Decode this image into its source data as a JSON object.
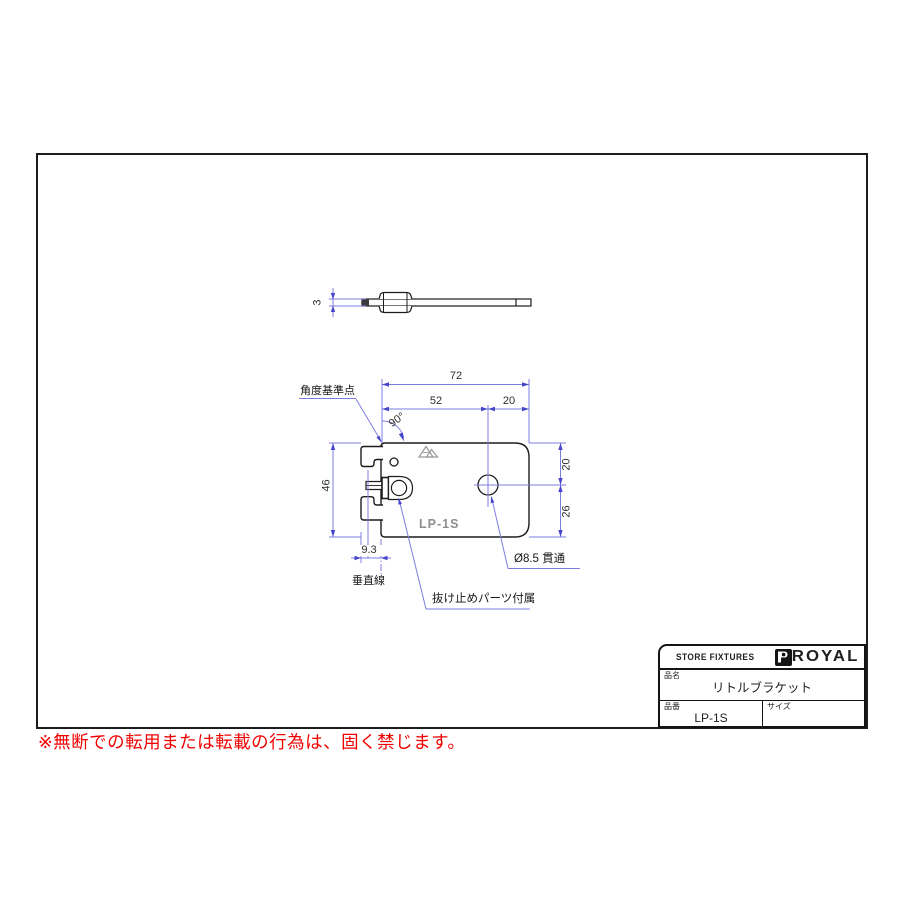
{
  "colors": {
    "outline": "#1c1c1c",
    "dim_line": "#7d7de0",
    "dim_arrow": "#4646cc",
    "dim_text": "#2e2e2e",
    "stamp_gray": "#8e8e8e",
    "warning_red": "#f10000"
  },
  "side_view": {
    "dim_thickness": "3"
  },
  "plan_view": {
    "dim_total_width": "72",
    "dim_left_width": "52",
    "dim_right_width": "20",
    "dim_angle": "90°",
    "dim_height": "46",
    "dim_top": "20",
    "dim_bottom": "26",
    "dim_hook": "9.3",
    "label_angle_ref": "角度基準点",
    "label_vertical_line": "垂直線",
    "label_hole": "Ø8.5 貫通",
    "label_retainer": "抜け止めパーツ付属",
    "stamp_model": "LP-1S"
  },
  "title_block": {
    "store": "STORE FIXTURES",
    "brand": "ROYAL",
    "name_label": "品名",
    "name": "リトルブラケット",
    "code_label": "品番",
    "code": "LP-1S",
    "size_label": "サイズ",
    "size": ""
  },
  "footer": {
    "warning": "※無断での転用または転載の行為は、固く禁じます。"
  }
}
